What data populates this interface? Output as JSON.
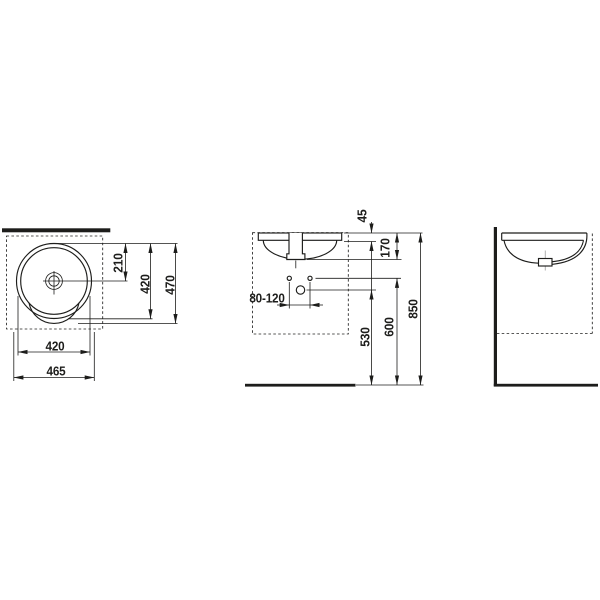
{
  "dimensions": {
    "top_view": {
      "center_from_front_edge": "210",
      "bowl_depth": "420",
      "overall_depth": "470",
      "bowl_width": "420",
      "overall_width": "465"
    },
    "front_view": {
      "rim_height": "45",
      "basin_depth_below_rim": "170",
      "fixing_hole_spacing": "80-120",
      "drain_outlet_height": "530",
      "fixing_holes_height": "600",
      "rim_height_above_floor": "850"
    }
  },
  "colors": {
    "line": "#1d1d1b",
    "centerline": "#b0b0b0",
    "background": "#ffffff"
  }
}
